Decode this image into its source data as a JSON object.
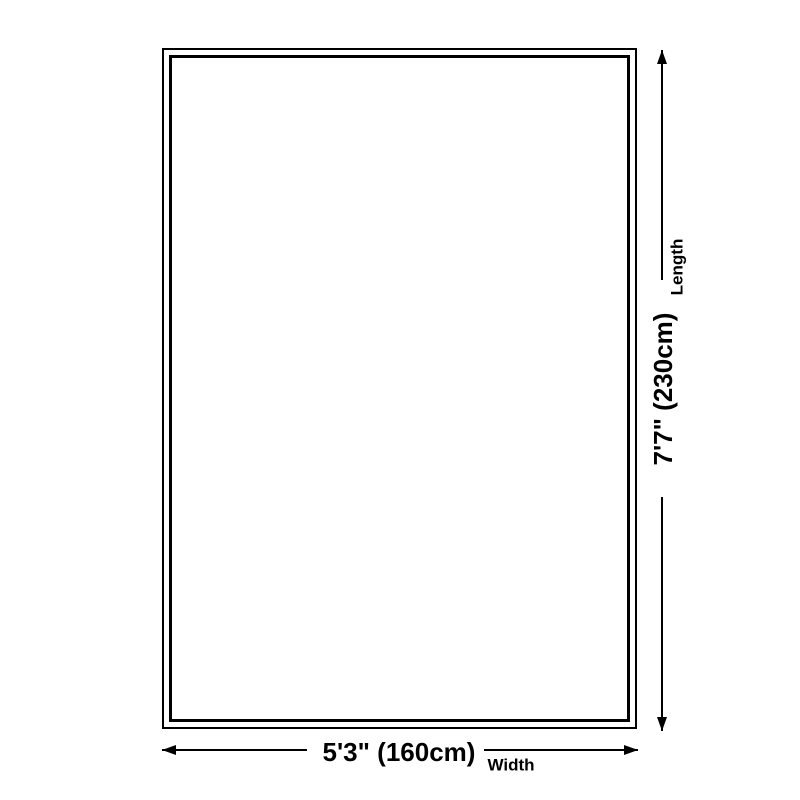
{
  "diagram": {
    "kind": "size-dimension-diagram",
    "background_color": "#ffffff",
    "line_color": "#000000",
    "width": {
      "value": "5'3\" (160cm)",
      "label": "Width"
    },
    "length": {
      "value": "7'7\" (230cm)",
      "label": "Length"
    },
    "icons": {
      "arrow_up": "css-triangle-up",
      "arrow_down": "css-triangle-down",
      "arrow_left": "css-triangle-left",
      "arrow_right": "css-triangle-right"
    }
  }
}
